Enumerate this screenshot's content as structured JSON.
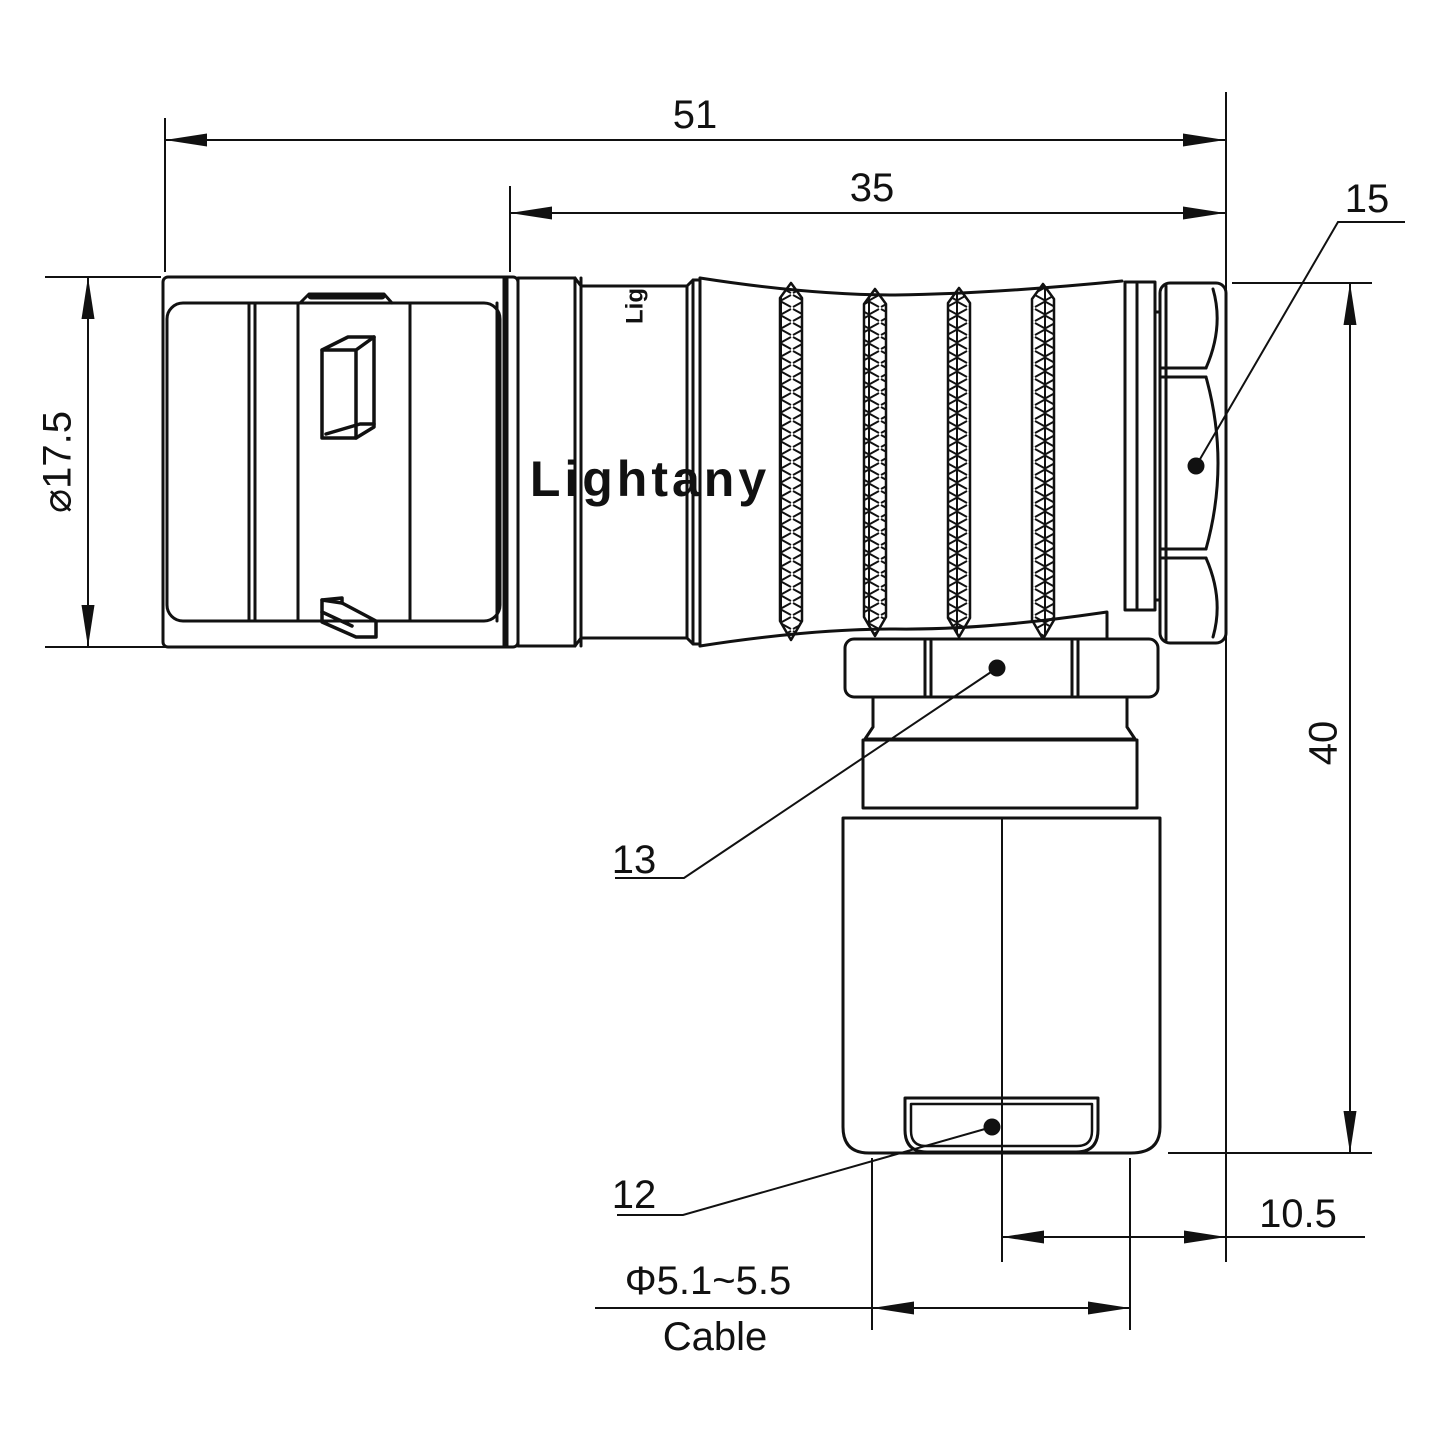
{
  "drawing": {
    "title": "Right-angle connector technical drawing",
    "colors": {
      "line": "#111111",
      "background": "#ffffff",
      "watermark": "#f2cbcb"
    },
    "watermark_text": "Lightany",
    "body_logo_text": "Lig",
    "labels": {
      "overall_length": "51",
      "rear_length": "35",
      "coupling_nut": "15",
      "front_diameter": "⌀17.5",
      "overall_height": "40",
      "backshell_nut": "13",
      "cable_bushing": "12",
      "axis_offset": "10.5",
      "cable_diameter": "Φ5.1~5.5",
      "cable_word": "Cable"
    }
  }
}
